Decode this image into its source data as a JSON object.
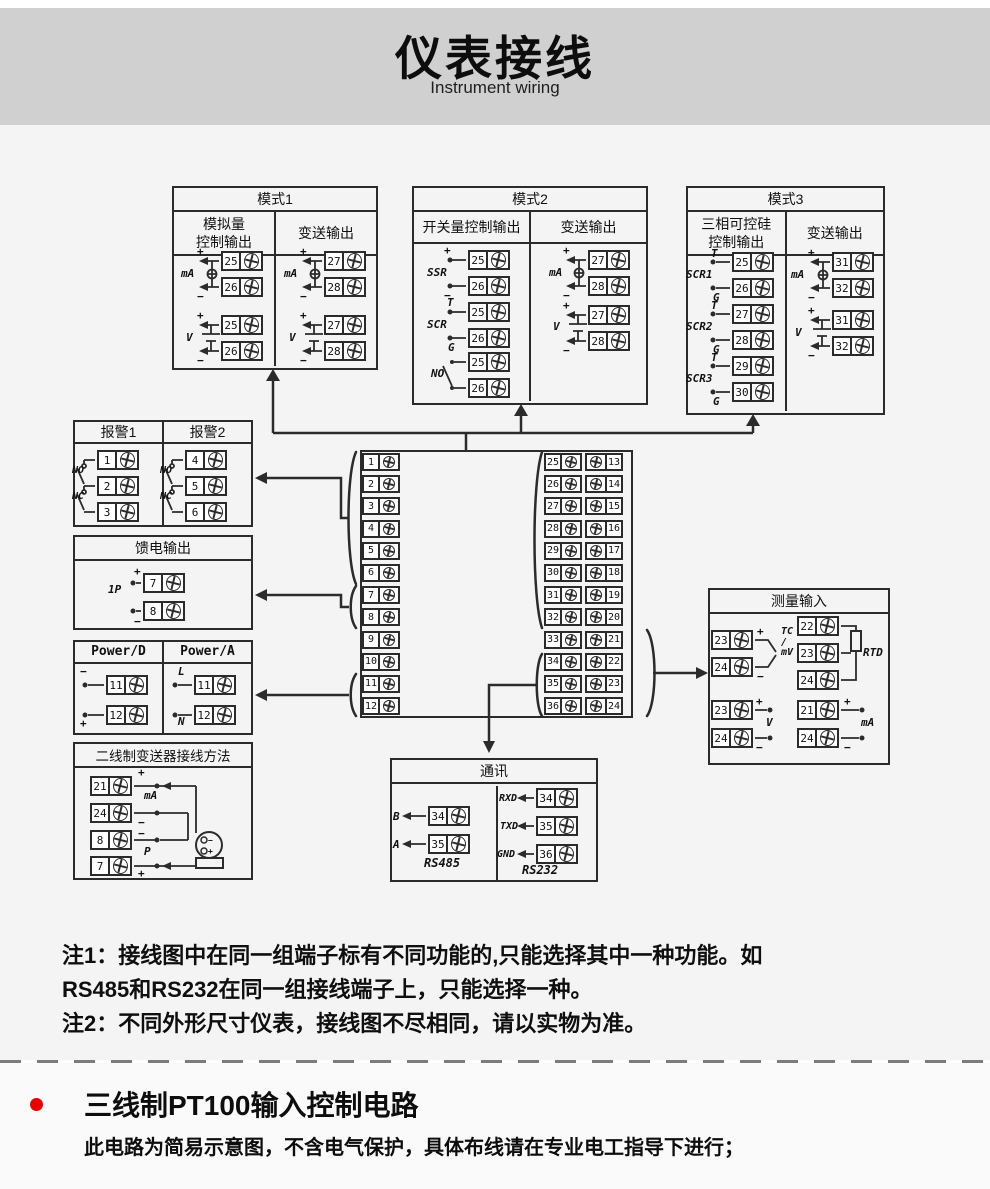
{
  "header": {
    "title": "仪表接线",
    "subtitle": "Instrument wiring"
  },
  "sym": {
    "plus": "+",
    "minus": "−",
    "ma": "mA",
    "v": "V",
    "t": "T",
    "g": "G",
    "ssr": "SSR",
    "scr": "SCR",
    "no": "NO",
    "nc": "NC",
    "p1": "1P",
    "l": "L",
    "n": "N",
    "p": "P",
    "b": "B",
    "a": "A",
    "rxd": "RXD",
    "txd": "TXD",
    "gnd": "GND",
    "tcmv": "TC\n/\nmV",
    "rtd": "RTD",
    "scr1": "SCR1",
    "scr2": "SCR2",
    "scr3": "SCR3",
    "rs485": "RS485",
    "rs232": "RS232"
  },
  "mode1": {
    "title": "模式1",
    "col1": "模拟量\n控制输出",
    "col2": "变送输出",
    "terms": [
      "25",
      "26",
      "25",
      "26",
      "27",
      "28",
      "27",
      "28"
    ]
  },
  "mode2": {
    "title": "模式2",
    "col1": "开关量控制输出",
    "col2": "变送输出",
    "terms": [
      "25",
      "26",
      "25",
      "26",
      "25",
      "26",
      "27",
      "28",
      "27",
      "28"
    ]
  },
  "mode3": {
    "title": "模式3",
    "col1": "三相可控硅\n控制输出",
    "col2": "变送输出",
    "terms": [
      "25",
      "26",
      "27",
      "28",
      "29",
      "30",
      "31",
      "32",
      "31",
      "32"
    ]
  },
  "alarm": {
    "col1": "报警1",
    "col2": "报警2",
    "terms": [
      "1",
      "2",
      "3",
      "4",
      "5",
      "6"
    ]
  },
  "feed": {
    "title": "馈电输出",
    "terms": [
      "7",
      "8"
    ]
  },
  "power": {
    "col1": "Power/D",
    "col2": "Power/A",
    "terms": [
      "11",
      "12",
      "11",
      "12"
    ]
  },
  "twowire": {
    "title": "二线制变送器接线方法",
    "terms": [
      "21",
      "24",
      "8",
      "7"
    ]
  },
  "central": {
    "left": [
      "1",
      "2",
      "3",
      "4",
      "5",
      "6",
      "7",
      "8",
      "9",
      "10",
      "11",
      "12"
    ],
    "mid": [
      "25",
      "26",
      "27",
      "28",
      "29",
      "30",
      "31",
      "32",
      "33",
      "34",
      "35",
      "36"
    ],
    "right": [
      "13",
      "14",
      "15",
      "16",
      "17",
      "18",
      "19",
      "20",
      "21",
      "22",
      "23",
      "24"
    ]
  },
  "measure": {
    "title": "测量输入",
    "tc": [
      "23",
      "24"
    ],
    "rtd": [
      "22",
      "23",
      "24"
    ],
    "volt": [
      "23",
      "24"
    ],
    "amp": [
      "21",
      "24"
    ]
  },
  "comm": {
    "title": "通讯",
    "rs485_terms": [
      "34",
      "35"
    ],
    "rs232_terms": [
      "34",
      "35",
      "36"
    ]
  },
  "notes": {
    "line1": "注1：接线图中在同一组端子标有不同功能的,只能选择其中一种功能。如",
    "line2": "RS485和RS232在同一组接线端子上，只能选择一种。",
    "line3": "注2：不同外形尺寸仪表，接线图不尽相同，请以实物为准。"
  },
  "bottom": {
    "heading": "三线制PT100输入控制电路",
    "desc": "此电路为简易示意图，不含电气保护，具体布线请在专业电工指导下进行；"
  }
}
